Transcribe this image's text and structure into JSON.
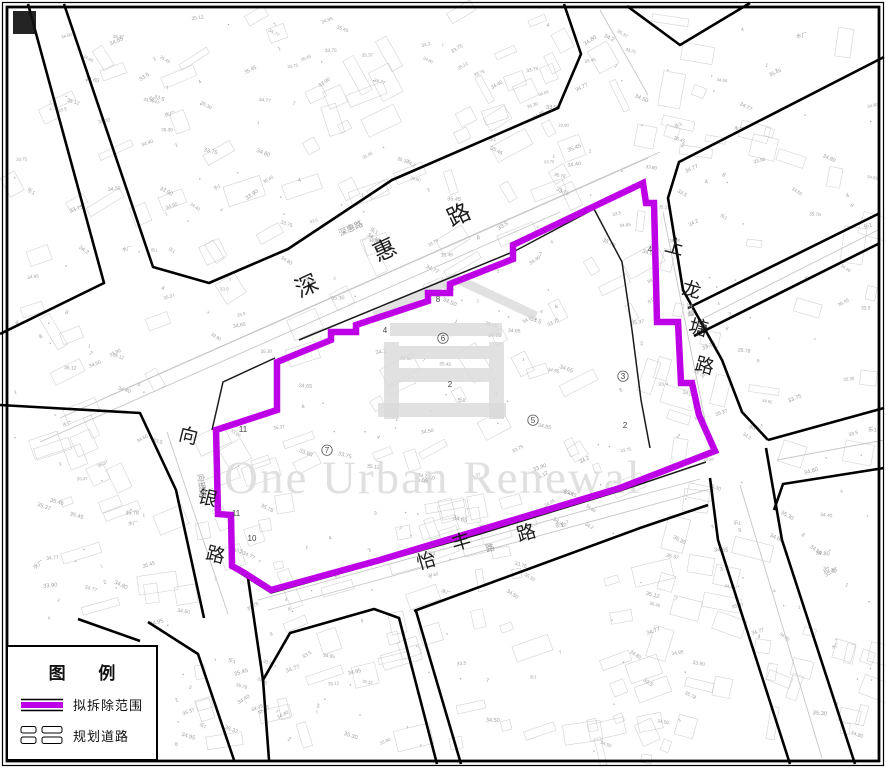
{
  "legend": {
    "title": "图 例",
    "items": [
      {
        "key": "demolition-scope",
        "label": "拟拆除范围"
      },
      {
        "key": "planned-road",
        "label": "规划道路"
      }
    ]
  },
  "map": {
    "frame_color": "#000000",
    "boundary": {
      "name": "拟拆除范围",
      "color": "#be00e6",
      "width": 6.5,
      "points": [
        [
          643,
          183
        ],
        [
          646,
          203
        ],
        [
          654,
          203
        ],
        [
          657,
          322
        ],
        [
          678,
          322
        ],
        [
          681,
          383
        ],
        [
          692,
          383
        ],
        [
          699,
          415
        ],
        [
          715,
          451
        ],
        [
          620,
          488
        ],
        [
          380,
          560
        ],
        [
          271,
          590
        ],
        [
          243,
          572
        ],
        [
          232,
          566
        ],
        [
          231,
          515
        ],
        [
          218,
          514
        ],
        [
          216,
          430
        ],
        [
          277,
          410
        ],
        [
          277,
          362
        ],
        [
          331,
          340
        ],
        [
          331,
          332
        ],
        [
          356,
          332
        ],
        [
          356,
          325
        ],
        [
          428,
          301
        ],
        [
          428,
          293
        ],
        [
          450,
          293
        ],
        [
          450,
          284
        ],
        [
          513,
          259
        ],
        [
          513,
          245
        ]
      ]
    },
    "roads": [
      {
        "points": [
          [
            28,
            4
          ],
          [
            104,
            283
          ],
          [
            0,
            334
          ]
        ]
      },
      {
        "points": [
          [
            64,
            4
          ],
          [
            153,
            267
          ],
          [
            209,
            283
          ],
          [
            288,
            249
          ],
          [
            392,
            180
          ],
          [
            558,
            108
          ],
          [
            581,
            54
          ],
          [
            564,
            4
          ]
        ]
      },
      {
        "points": [
          [
            627,
            6
          ],
          [
            680,
            45
          ],
          [
            750,
            3
          ]
        ]
      },
      {
        "points": [
          [
            884,
            57
          ],
          [
            679,
            162
          ],
          [
            668,
            198
          ],
          [
            683,
            290
          ],
          [
            722,
            360
          ],
          [
            742,
            412
          ],
          [
            768,
            440
          ]
        ]
      },
      {
        "points": [
          [
            768,
            440
          ],
          [
            884,
            408
          ]
        ]
      },
      {
        "points": [
          [
            774,
            510
          ],
          [
            783,
            484
          ],
          [
            884,
            468
          ]
        ]
      },
      {
        "points": [
          [
            710,
            478
          ],
          [
            718,
            540
          ],
          [
            790,
            764
          ]
        ]
      },
      {
        "points": [
          [
            766,
            448
          ],
          [
            782,
            540
          ],
          [
            855,
            764
          ]
        ]
      },
      {
        "points": [
          [
            0,
            405
          ],
          [
            140,
            413
          ],
          [
            176,
            490
          ],
          [
            204,
            618
          ]
        ]
      },
      {
        "points": [
          [
            148,
            622
          ],
          [
            198,
            654
          ],
          [
            234,
            760
          ]
        ]
      },
      {
        "points": [
          [
            248,
            578
          ],
          [
            263,
            680
          ],
          [
            269,
            760
          ]
        ]
      },
      {
        "points": [
          [
            263,
            680
          ],
          [
            290,
            633
          ],
          [
            374,
            609
          ],
          [
            399,
            618
          ],
          [
            437,
            764
          ]
        ]
      },
      {
        "points": [
          [
            416,
            611
          ],
          [
            461,
            764
          ]
        ]
      },
      {
        "points": [
          [
            414,
            611
          ],
          [
            640,
            528
          ],
          [
            708,
            505
          ]
        ]
      },
      {
        "points": [
          [
            78,
            619
          ],
          [
            140,
            641
          ]
        ]
      },
      {
        "points": [
          [
            688,
            308
          ],
          [
            880,
            213
          ]
        ]
      },
      {
        "points": [
          [
            694,
            336
          ],
          [
            880,
            243
          ]
        ]
      }
    ],
    "inner_lines": [
      {
        "points": [
          [
            212,
            430
          ],
          [
            223,
            382
          ],
          [
            275,
            358
          ]
        ]
      },
      {
        "points": [
          [
            299,
            340
          ],
          [
            515,
            251
          ],
          [
            594,
            209
          ]
        ]
      },
      {
        "points": [
          [
            594,
            209
          ],
          [
            622,
            262
          ],
          [
            632,
            330
          ],
          [
            641,
            400
          ],
          [
            650,
            448
          ]
        ]
      },
      {
        "points": [
          [
            233,
            569
          ],
          [
            271,
            593
          ],
          [
            480,
            534
          ],
          [
            620,
            491
          ],
          [
            706,
            462
          ]
        ]
      }
    ],
    "lane_lines": [
      {
        "points": [
          [
            60,
            418
          ],
          [
            648,
            158
          ]
        ]
      },
      {
        "points": [
          [
            40,
            442
          ],
          [
            560,
            212
          ]
        ]
      },
      {
        "points": [
          [
            100,
            400
          ],
          [
            660,
            152
          ]
        ]
      },
      {
        "points": [
          [
            268,
            610
          ],
          [
            710,
            489
          ]
        ]
      },
      {
        "points": [
          [
            258,
            600
          ],
          [
            700,
            479
          ]
        ]
      },
      {
        "points": [
          [
            167,
            432
          ],
          [
            228,
            614
          ]
        ]
      },
      {
        "points": [
          [
            663,
            212
          ],
          [
            706,
            425
          ]
        ]
      },
      {
        "points": [
          [
            600,
            10
          ],
          [
            648,
            95
          ]
        ]
      },
      {
        "points": [
          [
            740,
            485
          ],
          [
            822,
            758
          ]
        ]
      },
      {
        "points": [
          [
            777,
            460
          ],
          [
            884,
            440
          ]
        ]
      },
      {
        "points": [
          [
            692,
            324
          ],
          [
            880,
            229
          ]
        ]
      }
    ],
    "road_labels": [
      {
        "text": "深",
        "x": 310,
        "y": 293,
        "size": 23,
        "rot": -25
      },
      {
        "text": "惠",
        "x": 388,
        "y": 257,
        "size": 23,
        "rot": -25
      },
      {
        "text": "路",
        "x": 462,
        "y": 222,
        "size": 23,
        "rot": -25
      },
      {
        "text": "上",
        "x": 673,
        "y": 253,
        "size": 19,
        "rot": 15
      },
      {
        "text": "龙",
        "x": 690,
        "y": 296,
        "size": 19,
        "rot": 15
      },
      {
        "text": "塘",
        "x": 697,
        "y": 334,
        "size": 19,
        "rot": 15
      },
      {
        "text": "路",
        "x": 703,
        "y": 372,
        "size": 19,
        "rot": 15
      },
      {
        "text": "向",
        "x": 187,
        "y": 442,
        "size": 19,
        "rot": 14
      },
      {
        "text": "银",
        "x": 206,
        "y": 504,
        "size": 19,
        "rot": 14
      },
      {
        "text": "路",
        "x": 214,
        "y": 561,
        "size": 19,
        "rot": 14
      },
      {
        "text": "怡",
        "x": 428,
        "y": 567,
        "size": 19,
        "rot": -16
      },
      {
        "text": "丰",
        "x": 463,
        "y": 548,
        "size": 19,
        "rot": -16
      },
      {
        "text": "路",
        "x": 528,
        "y": 539,
        "size": 19,
        "rot": -16
      }
    ],
    "small_labels": [
      {
        "text": "深惠路",
        "x": 352,
        "y": 231,
        "size": 8.5,
        "rot": -25
      },
      {
        "text": "向银路",
        "x": 199,
        "y": 486,
        "size": 8,
        "rot": 84
      },
      {
        "text": "路",
        "x": 491,
        "y": 551,
        "size": 9,
        "rot": -16
      },
      {
        "text": "龙塘",
        "x": 688,
        "y": 310,
        "size": 7,
        "rot": 84
      }
    ],
    "parcel_labels": [
      {
        "text": "6",
        "x": 443,
        "y": 341,
        "circled": true
      },
      {
        "text": "7",
        "x": 327,
        "y": 453,
        "circled": true
      },
      {
        "text": "5",
        "x": 533,
        "y": 423,
        "circled": true
      },
      {
        "text": "3",
        "x": 623,
        "y": 379,
        "circled": true
      },
      {
        "text": "4",
        "x": 385,
        "y": 333
      },
      {
        "text": "8",
        "x": 438,
        "y": 302
      },
      {
        "text": "2",
        "x": 450,
        "y": 387
      },
      {
        "text": "2",
        "x": 625,
        "y": 428
      },
      {
        "text": "4",
        "x": 650,
        "y": 252
      },
      {
        "text": "10",
        "x": 252,
        "y": 541
      },
      {
        "text": "11",
        "x": 243,
        "y": 432
      },
      {
        "text": "11",
        "x": 236,
        "y": 516
      }
    ],
    "watermark": {
      "text": "One Urban Renewal",
      "x": 224,
      "y": 493,
      "size": 47,
      "color": "#e0e0e0",
      "logo_color": "#d9d9d9",
      "logo": {
        "roof": [
          [
            374,
            316
          ],
          [
            455,
            278
          ],
          [
            536,
            316
          ]
        ],
        "bars": [
          [
            390,
            323,
            112,
            13
          ],
          [
            384,
            342,
            15,
            77
          ],
          [
            489,
            342,
            15,
            77
          ],
          [
            399,
            346,
            90,
            13
          ],
          [
            399,
            368,
            90,
            14
          ],
          [
            378,
            403,
            128,
            14
          ]
        ]
      }
    },
    "noise": {
      "seed": 20240607,
      "rect_count": 260,
      "label_count": 380,
      "dot_count": 120,
      "color": "#adadad",
      "text_color": "#8f8f8f",
      "samples": [
        "34.80",
        "34.65",
        "35.12",
        "33.75",
        "34.50",
        "35.30",
        "34.95",
        "34.40",
        "33.90",
        "35.45",
        "34.2",
        "35.78",
        "34.77",
        "35.37",
        "33.5",
        "1",
        "2",
        "3",
        "4",
        "7",
        "8",
        "乐1",
        "水厂"
      ]
    }
  }
}
